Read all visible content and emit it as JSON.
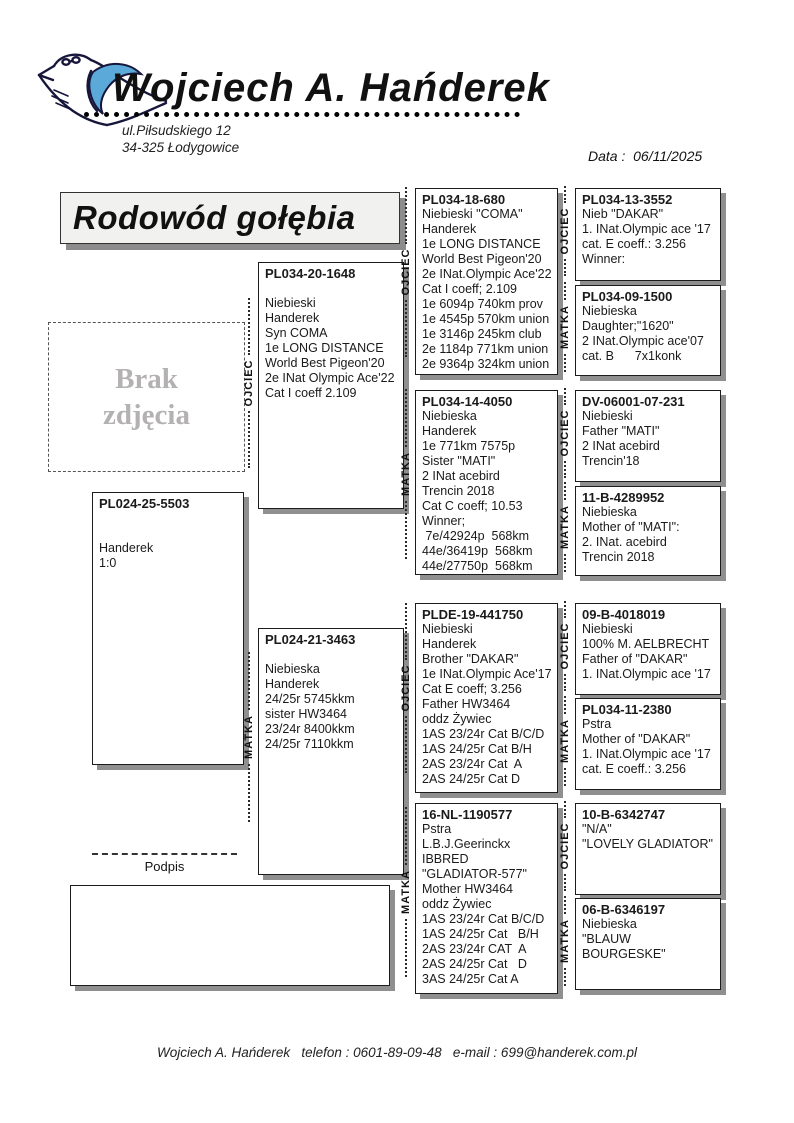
{
  "header": {
    "name": "Wojciech A. Hańderek",
    "address_line1": "ul.Piłsudskiego 12",
    "address_line2": "34-325 Łodygowice",
    "date_label": "Data :  ",
    "date_value": "06/11/2025",
    "logo_accent_color": "#5ba9d9"
  },
  "doc_title": "Rodowód gołębia",
  "photo_placeholder": "Brak zdjęcia",
  "signature_label": "Podpis",
  "footer_text": "Wojciech A. Hańderek   telefon : 0601-89-09-48   e-mail : 699@handerek.com.pl",
  "labels": {
    "father": "OJCIEC",
    "mother": "MATKA"
  },
  "pedigree": {
    "subject": {
      "ring": "PL024-25-5503",
      "lines": [
        "",
        "",
        "Handerek",
        "1:0"
      ]
    },
    "gen1": [
      {
        "role": "father",
        "ring": "PL034-20-1648",
        "lines": [
          "",
          "Niebieski",
          "Handerek",
          "Syn COMA",
          "1e LONG DISTANCE",
          "World Best Pigeon'20",
          "2e INat Olympic Ace'22",
          "Cat I coeff 2.109"
        ]
      },
      {
        "role": "mother",
        "ring": "PL024-21-3463",
        "lines": [
          "",
          "Niebieska",
          "Handerek",
          "24/25r 5745kkm",
          "sister HW3464",
          "23/24r 8400kkm",
          "24/25r 7110kkm"
        ]
      }
    ],
    "gen2": [
      {
        "role": "father",
        "ring": "PL034-18-680",
        "lines": [
          "Niebieski \"COMA\"",
          "Handerek",
          "1e LONG DISTANCE",
          "World Best Pigeon'20",
          "2e INat.Olympic Ace'22",
          "Cat I coeff; 2.109",
          "1e 6094p 740km prov",
          "1e 4545p 570km union",
          "1e 3146p 245km club",
          "2e 1184p 771km union",
          "2e 9364p 324km union"
        ]
      },
      {
        "role": "mother",
        "ring": "PL034-14-4050",
        "lines": [
          "Niebieska",
          "Handerek",
          "1e 771km 7575p",
          "Sister \"MATI\"",
          "2 INat acebird",
          "Trencin 2018",
          "Cat C coeff; 10.53",
          "Winner;",
          " 7e/42924p  568km",
          "44e/36419p  568km",
          "44e/27750p  568km"
        ]
      },
      {
        "role": "father",
        "ring": "PLDE-19-441750",
        "lines": [
          "Niebieski",
          "Handerek",
          "Brother \"DAKAR\"",
          "1e INat.Olympic Ace'17",
          "Cat E coeff; 3.256",
          "Father HW3464",
          "oddz Żywiec",
          "1AS 23/24r Cat B/C/D",
          "1AS 24/25r Cat B/H",
          "2AS 23/24r Cat  A",
          "2AS 24/25r Cat D"
        ]
      },
      {
        "role": "mother",
        "ring": "16-NL-1190577",
        "lines": [
          "Pstra",
          "L.B.J.Geerinckx",
          "IBBRED",
          "\"GLADIATOR-577\"",
          "Mother HW3464",
          "oddz Żywiec",
          "1AS 23/24r Cat B/C/D",
          "1AS 24/25r Cat   B/H",
          "2AS 23/24r CAT  A",
          "2AS 24/25r Cat   D",
          "3AS 24/25r Cat A"
        ]
      }
    ],
    "gen3": [
      {
        "role": "father",
        "ring": "PL034-13-3552",
        "lines": [
          "Nieb \"DAKAR\"",
          "1. INat.Olympic ace '17",
          "cat. E coeff.: 3.256",
          "Winner:"
        ]
      },
      {
        "role": "mother",
        "ring": "PL034-09-1500",
        "lines": [
          "Niebieska",
          "Daughter;\"1620\"",
          "2 INat.Olympic ace'07",
          "cat. B      7x1konk"
        ]
      },
      {
        "role": "father",
        "ring": "DV-06001-07-231",
        "lines": [
          "Niebieski",
          "Father \"MATI\"",
          "2 INat acebird",
          "Trencin'18"
        ]
      },
      {
        "role": "mother",
        "ring": "11-B-4289952",
        "lines": [
          "Niebieska",
          "Mother of \"MATI\":",
          "2. INat. acebird",
          "Trencin 2018"
        ]
      },
      {
        "role": "father",
        "ring": "09-B-4018019",
        "lines": [
          "Niebieski",
          "100% M. AELBRECHT",
          "Father of \"DAKAR\"",
          "1. INat.Olympic ace '17"
        ]
      },
      {
        "role": "mother",
        "ring": "PL034-11-2380",
        "lines": [
          "Pstra",
          "Mother of \"DAKAR\"",
          "1. INat.Olympic ace '17",
          "cat. E coeff.: 3.256"
        ]
      },
      {
        "role": "father",
        "ring": "10-B-6342747",
        "lines": [
          "\"N/A\"",
          "\"LOVELY GLADIATOR\""
        ]
      },
      {
        "role": "mother",
        "ring": "06-B-6346197",
        "lines": [
          "Niebieska",
          "\"BLAUW BOURGESKE\""
        ]
      }
    ]
  }
}
